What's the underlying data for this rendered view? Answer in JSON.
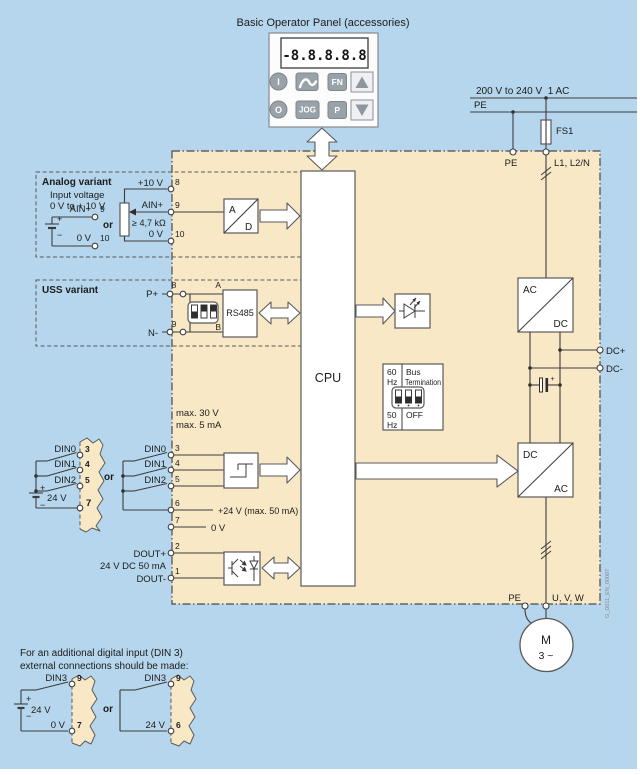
{
  "colors": {
    "background": "#b5d6ec",
    "block_fill": "#f8e8c6",
    "button_gray": "#99a1a9",
    "line": "#3d3d3d"
  },
  "panel": {
    "title": "Basic Operator Panel (accessories)",
    "display": "-8.8.8.8.8",
    "btn_i": "I",
    "btn_fn": "FN",
    "btn_o": "O",
    "btn_jog": "JOG",
    "btn_p": "P"
  },
  "supply": {
    "rating": "200 V to 240 V  1 AC",
    "pe": "PE",
    "fuse": "FS1",
    "term_pe": "PE",
    "term_line": "L1, L2/N"
  },
  "analog": {
    "title": "Analog variant",
    "note1": "Input voltage",
    "note2": "0 V to + 10 V",
    "src_ain_label": "AIN+",
    "src_ain_pin": "9",
    "src_0v_label": "0 V",
    "src_0v_pin": "10",
    "plus": "+",
    "minus": "−",
    "or": "or",
    "pot_10v_label": "+10 V",
    "pot_10v_pin": "8",
    "pot_ain_label": "AIN+",
    "pot_ain_pin": "9",
    "pot_res": "≥ 4,7 kΩ",
    "pot_0v_label": "0 V",
    "pot_0v_pin": "10",
    "ad_a": "A",
    "ad_d": "D"
  },
  "uss": {
    "title": "USS variant",
    "p_label": "P+",
    "p_pin": "8",
    "n_label": "N-",
    "n_pin": "9",
    "wire_a": "A",
    "wire_b": "B",
    "rs485": "RS485"
  },
  "cpu": {
    "label": "CPU"
  },
  "bus_term": {
    "f60": "60",
    "hz1": "Hz",
    "bus": "Bus",
    "termination": "Termination",
    "f50": "50",
    "hz2": "Hz",
    "off": "OFF"
  },
  "din": {
    "max_v": "max. 30 V",
    "max_i": "max. 5 mA",
    "or": "or",
    "ext": {
      "din0": "DIN0",
      "p0": "3",
      "din1": "DIN1",
      "p1": "4",
      "din2": "DIN2",
      "p2": "5",
      "plus": "+",
      "minus": "−",
      "batt": "24 V",
      "p7": "7"
    },
    "int": {
      "din0": "DIN0",
      "p0": "3",
      "din1": "DIN1",
      "p1": "4",
      "din2": "DIN2",
      "p2": "5",
      "p6": "6",
      "v24": "+24 V (max. 50 mA)",
      "p7": "7",
      "v0": "0 V"
    }
  },
  "dout": {
    "p2": "2",
    "plus": "DOUT+",
    "rating": "24 V DC 50 mA",
    "p1": "1",
    "minus": "DOUT-"
  },
  "rectifier": {
    "in": "AC",
    "out": "DC"
  },
  "dclink": {
    "plus": "DC+",
    "minus": "DC-",
    "cap_plus": "+"
  },
  "inverter": {
    "in": "DC",
    "out": "AC"
  },
  "out_terms": {
    "pe": "PE",
    "uvw": "U, V, W"
  },
  "motor": {
    "m": "M",
    "ph": "3 ~"
  },
  "note": {
    "l1": "For an additional digital input (DIN 3)",
    "l2": "external connections should be made:",
    "or": "or",
    "ext": {
      "din3": "DIN3",
      "p9": "9",
      "plus": "+",
      "minus": "−",
      "batt": "24 V",
      "v0": "0 V",
      "p7": "7"
    },
    "int": {
      "din3": "DIN3",
      "p9": "9",
      "v24": "24 V",
      "p6": "6"
    }
  },
  "watermark": "G_D011_EN_00007"
}
